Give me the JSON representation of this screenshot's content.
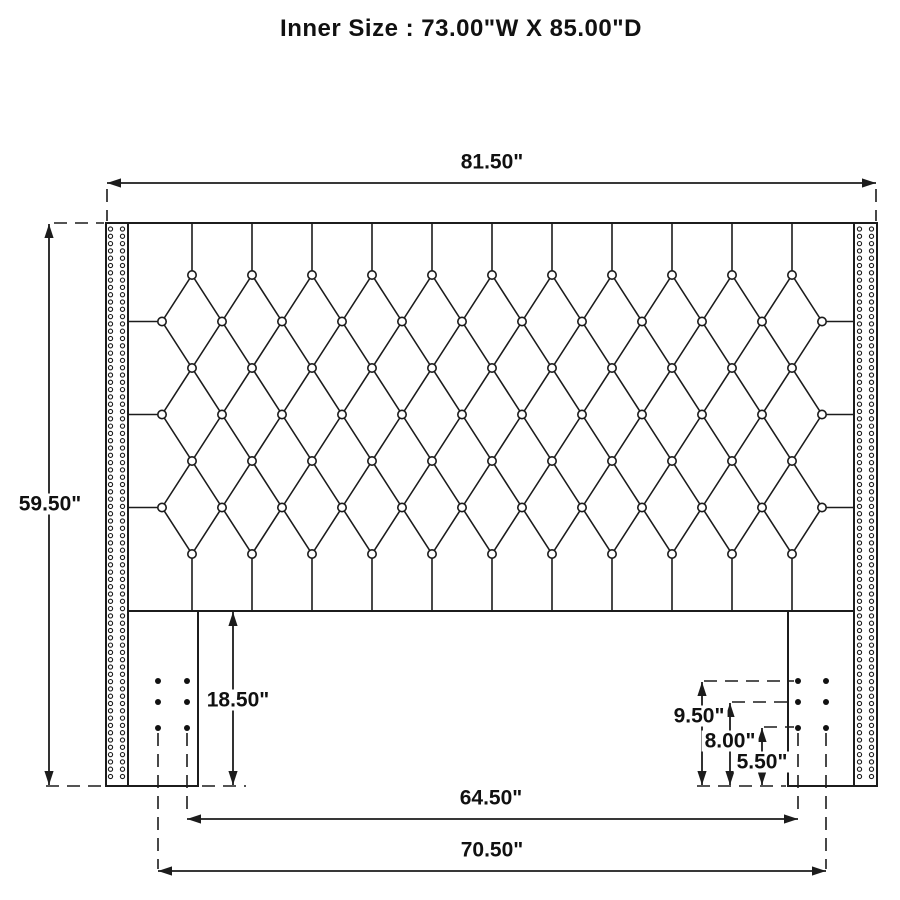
{
  "title": "Inner Size : 73.00\"W X 85.00\"D",
  "labels": {
    "width_overall": "81.50\"",
    "height_overall": "59.50\"",
    "leg_height": "18.50\"",
    "hole_950": "9.50\"",
    "hole_800": "8.00\"",
    "hole_550": "5.50\"",
    "span_inner": "64.50\"",
    "span_outer": "70.50\""
  },
  "diagram": {
    "frame_lines": [
      [
        106,
        223,
        877,
        223
      ],
      [
        106,
        223,
        106,
        786
      ],
      [
        128,
        223,
        128,
        786
      ],
      [
        854,
        223,
        854,
        786
      ],
      [
        877,
        223,
        877,
        786
      ],
      [
        128,
        611,
        854,
        611
      ],
      [
        198,
        611,
        198,
        786
      ],
      [
        788,
        611,
        788,
        786
      ],
      [
        106,
        786,
        198,
        786
      ],
      [
        788,
        786,
        877,
        786
      ]
    ],
    "dashed_lines": [
      [
        107,
        189,
        107,
        221
      ],
      [
        876,
        189,
        876,
        221
      ],
      [
        54,
        223,
        104,
        223
      ],
      [
        46,
        786,
        103,
        786
      ],
      [
        202,
        786,
        246,
        786
      ],
      [
        704,
        681,
        794,
        681
      ],
      [
        732,
        702,
        794,
        702
      ],
      [
        764,
        727,
        794,
        727
      ],
      [
        697,
        786,
        786,
        786
      ],
      [
        158,
        733,
        158,
        869
      ],
      [
        187,
        733,
        187,
        817
      ],
      [
        798,
        733,
        798,
        817
      ],
      [
        826,
        733,
        826,
        869
      ]
    ],
    "nailheads": {
      "columns": [
        110.5,
        122.5,
        859.5,
        871.5
      ],
      "y0": 229,
      "y1": 782,
      "step": 7.3,
      "r": 2.1
    },
    "tufting": {
      "top": 223,
      "bottom": 611,
      "left": 128,
      "right": 854,
      "x_odd": 192,
      "n_odd": 11,
      "x_even": 162,
      "n_even": 12,
      "dx": 60,
      "y0": 275,
      "dy": 46.5,
      "rows": 7,
      "button_r": 4.2
    },
    "bolts": {
      "x_left": [
        158,
        187
      ],
      "x_right": [
        798,
        826
      ],
      "y": [
        681,
        702,
        728
      ],
      "r": 3
    },
    "dims": [
      {
        "name": "overall-width-dim",
        "o": "h",
        "p": 183,
        "a": 107,
        "b": 876,
        "key": "width_overall"
      },
      {
        "name": "overall-height-dim",
        "o": "v",
        "p": 49,
        "a": 224,
        "b": 785,
        "key": "height_overall"
      },
      {
        "name": "leg-height-dim",
        "o": "v",
        "p": 233,
        "a": 612,
        "b": 785,
        "key": "leg_height"
      },
      {
        "name": "bolt-950-dim",
        "o": "v",
        "p": 702,
        "a": 682,
        "b": 785,
        "key": "hole_950"
      },
      {
        "name": "bolt-800-dim",
        "o": "v",
        "p": 730,
        "a": 703,
        "b": 785,
        "key": "hole_800"
      },
      {
        "name": "bolt-550-dim",
        "o": "v",
        "p": 762,
        "a": 728,
        "b": 785,
        "key": "hole_550"
      },
      {
        "name": "inner-bolt-span-dim",
        "o": "h",
        "p": 819,
        "a": 187,
        "b": 798,
        "key": "span_inner"
      },
      {
        "name": "outer-bolt-span-dim",
        "o": "h",
        "p": 871,
        "a": 158,
        "b": 826,
        "key": "span_outer"
      }
    ],
    "arrow": {
      "len": 14,
      "half_w": 4.6
    }
  }
}
